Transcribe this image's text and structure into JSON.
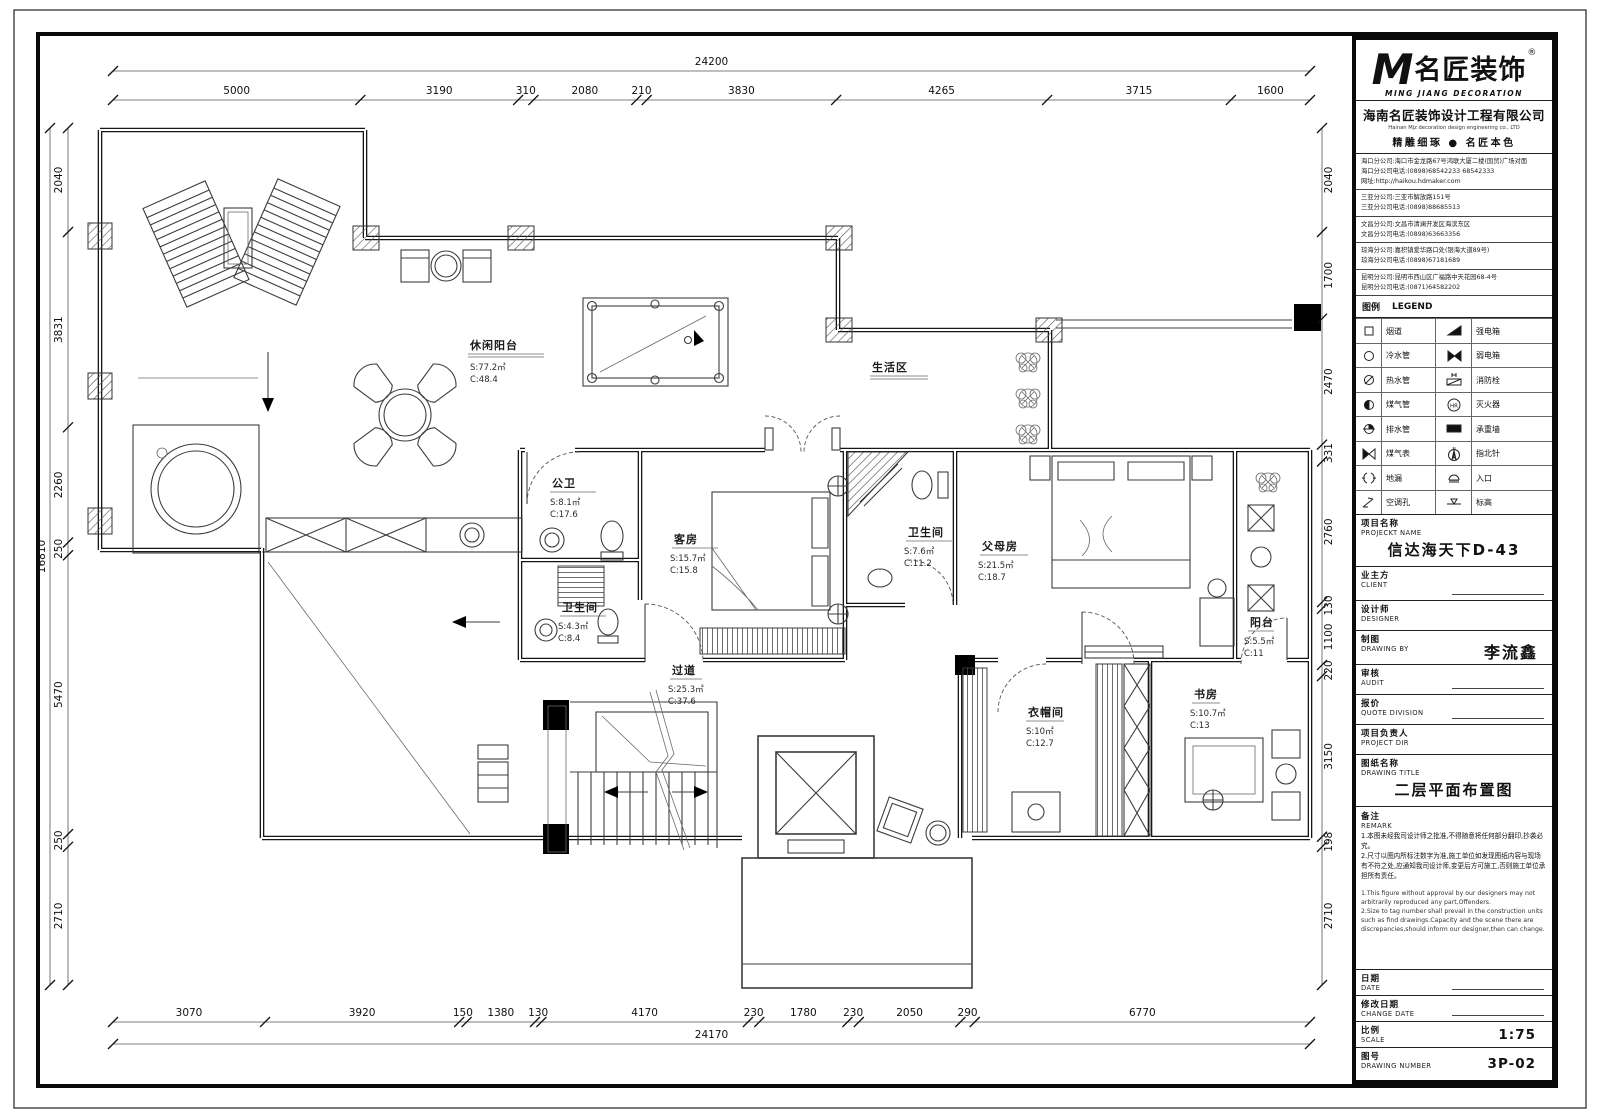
{
  "titleblock": {
    "logo": {
      "mark": "M",
      "brand": "名匠装饰",
      "reg": "®",
      "sub": "MING JIANG DECORATION"
    },
    "company": {
      "name": "海南名匠装饰设计工程有限公司",
      "name_en": "Hainan Mjz decoration design engineering co., LTD",
      "slogan": "精雕细琢 ● 名匠本色"
    },
    "branches": [
      {
        "lines": [
          "海口分公司:海口市金龙路67号鸿联大厦二楼(国贸)广场对面",
          "海口分公司电话:(0898)68542233 68542333",
          "网址:http://haikou.hdmaker.com"
        ]
      },
      {
        "lines": [
          "三亚分公司:三亚市解放路151号",
          "三亚分公司电话:(0898)88685513"
        ]
      },
      {
        "lines": [
          "文昌分公司:文昌市清澜开发区海滨东区",
          "文昌分公司电话:(0898)63663356"
        ]
      },
      {
        "lines": [
          "琼海分公司:嘉积镇爱华路口处(银海大道89号)",
          "琼海分公司电话:(0898)67181689"
        ]
      },
      {
        "lines": [
          "昆明分公司:昆明市西山区广福路中天花园68-4号",
          "昆明分公司电话:(0871)64582202"
        ]
      }
    ],
    "legend": {
      "title_cn": "图例",
      "title_en": "LEGEND",
      "rows": [
        {
          "left": "烟道",
          "right": "强电箱"
        },
        {
          "left": "冷水管",
          "right": "弱电箱"
        },
        {
          "left": "热水管",
          "right": "消防栓"
        },
        {
          "left": "煤气管",
          "right": "灭火器"
        },
        {
          "left": "排水管",
          "right": "承重墙"
        },
        {
          "left": "煤气表",
          "right": "指北针"
        },
        {
          "left": "地漏",
          "right": "入口"
        },
        {
          "left": "空调孔",
          "right": "标高"
        }
      ]
    },
    "fields": {
      "project": {
        "label_cn": "项目名称",
        "label_en": "PROJECKT NAME",
        "value": "信达海天下D-43"
      },
      "client": {
        "label_cn": "业主方",
        "label_en": "CLIENT",
        "value": ""
      },
      "designer": {
        "label_cn": "设计师",
        "label_en": "DESIGNER",
        "value": ""
      },
      "drawing_by": {
        "label_cn": "制图",
        "label_en": "DRAWING BY",
        "value": "李流鑫"
      },
      "audit": {
        "label_cn": "审核",
        "label_en": "AUDIT",
        "value": ""
      },
      "quote": {
        "label_cn": "报价",
        "label_en": "QUOTE DIVISION",
        "value": ""
      },
      "project_dir": {
        "label_cn": "项目负责人",
        "label_en": "PROJECT DIR",
        "value": ""
      },
      "drawing_title": {
        "label_cn": "图纸名称",
        "label_en": "DRAWING TITLE",
        "value": "二层平面布置图"
      },
      "remark": {
        "label_cn": "备注",
        "label_en": "REMARK",
        "notes_cn": [
          "1.本图未经我司设计师之批准,不得随意将任何部分翻印,抄袭必究。",
          "2.尺寸以图内所标注数字为准,施工单位如发现图纸内容与现场有不符之处,应通知我司设计师,变更后方可施工,否则施工单位承担所有责任。"
        ],
        "notes_en": [
          "1.This figure without approval by our designers may not arbitrarily reproduced any part,Offenders.",
          "2.Size to tag number shall prevail in the construction units such as find drawings.Capacity and the scene there are discrepancies,should inform our designer,then can change."
        ]
      },
      "date": {
        "label_cn": "日期",
        "label_en": "DATE",
        "value": ""
      },
      "change_date": {
        "label_cn": "修改日期",
        "label_en": "CHANGE DATE",
        "value": ""
      },
      "scale": {
        "label_cn": "比例",
        "label_en": "SCALE",
        "value": "1:75"
      },
      "number": {
        "label_cn": "图号",
        "label_en": "DRAWING NUMBER",
        "value": "3P-02"
      }
    }
  },
  "plan": {
    "rooms": {
      "leisure_balcony": {
        "name": "休闲阳台",
        "s": "S:77.2㎡",
        "c": "C:48.4"
      },
      "living_zone": {
        "name": "生活区"
      },
      "public_bath": {
        "name": "公卫",
        "s": "S:8.1㎡",
        "c": "C:17.6"
      },
      "guest_room": {
        "name": "客房",
        "s": "S:15.7㎡",
        "c": "C:15.8"
      },
      "bath2": {
        "name": "卫生间",
        "s": "S:7.6㎡",
        "c": "C:11.2"
      },
      "parents_room": {
        "name": "父母房",
        "s": "S:21.5㎡",
        "c": "C:18.7"
      },
      "bath1": {
        "name": "卫生间",
        "s": "S:4.3㎡",
        "c": "C:8.4"
      },
      "corridor": {
        "name": "过道",
        "s": "S:25.3㎡",
        "c": "C:37.6"
      },
      "balcony": {
        "name": "阳台",
        "s": "S:5.5㎡",
        "c": "C:11"
      },
      "cloakroom": {
        "name": "衣帽间",
        "s": "S:10㎡",
        "c": "C:12.7"
      },
      "study": {
        "name": "书房",
        "s": "S:10.7㎡",
        "c": "C:13"
      }
    },
    "dims": {
      "top_total": "24200",
      "top": [
        "5000",
        "3190",
        "310",
        "2080",
        "210",
        "3830",
        "4265",
        "3715",
        "1600"
      ],
      "bottom": [
        "3070",
        "3920",
        "150",
        "1380",
        "130",
        "4170",
        "230",
        "1780",
        "230",
        "2050",
        "290",
        "6770"
      ],
      "bottom_total": "24170",
      "left_total": "16810",
      "left": [
        "2040",
        "3831",
        "2260",
        "250",
        "5470",
        "250",
        "2710"
      ],
      "right": [
        "2040",
        "1700",
        "2470",
        "331",
        "2760",
        "130",
        "1100",
        "220",
        "3150",
        "198",
        "2710"
      ]
    }
  }
}
